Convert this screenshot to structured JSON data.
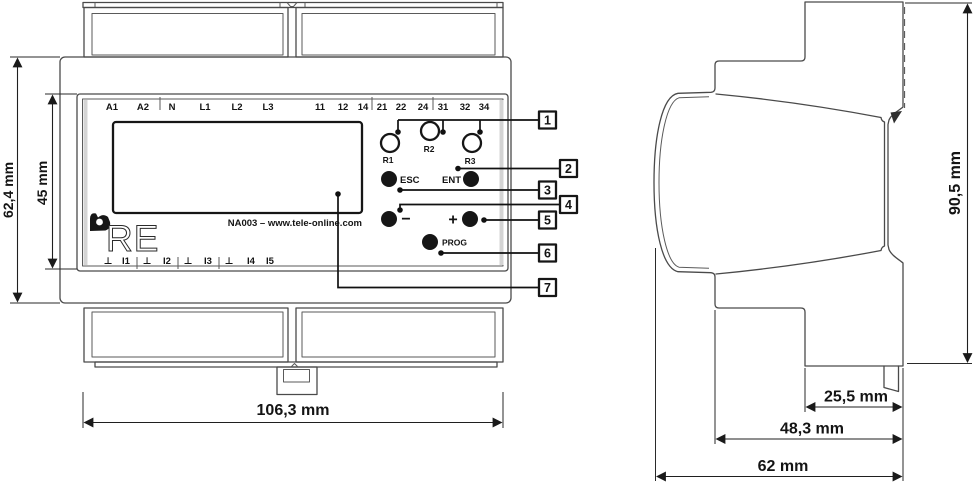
{
  "drawing": {
    "front_view": {
      "top_terminals": [
        "A1",
        "A2",
        "N",
        "L1",
        "L2",
        "L3",
        "11",
        "12",
        "14",
        "21",
        "22",
        "24",
        "31",
        "32",
        "34"
      ],
      "bottom_terminals": [
        "⊥",
        "I1",
        "⊥",
        "I2",
        "⊥",
        "I3",
        "⊥",
        "I4",
        "I5"
      ],
      "relays": [
        "R1",
        "R2",
        "R3"
      ],
      "buttons": {
        "esc": "ESC",
        "ent": "ENT",
        "minus": "−",
        "plus": "+",
        "prog": "PROG"
      },
      "display_note": "NA003 – www.tele-online.com",
      "brand": "RE",
      "dim_height": "62,4 mm",
      "dim_panel_height": "45 mm",
      "dim_width": "106,3 mm"
    },
    "side_view": {
      "dim_height": "90,5 mm",
      "dim_rear_depth": "25,5 mm",
      "dim_mid_depth": "48,3 mm",
      "dim_total_depth": "62 mm"
    },
    "callouts": [
      "1",
      "2",
      "3",
      "4",
      "5",
      "6",
      "7"
    ]
  },
  "colors": {
    "line": "#4a4a4a",
    "ink": "#141414",
    "shade": "#d4d4d4",
    "background": "#ffffff"
  }
}
